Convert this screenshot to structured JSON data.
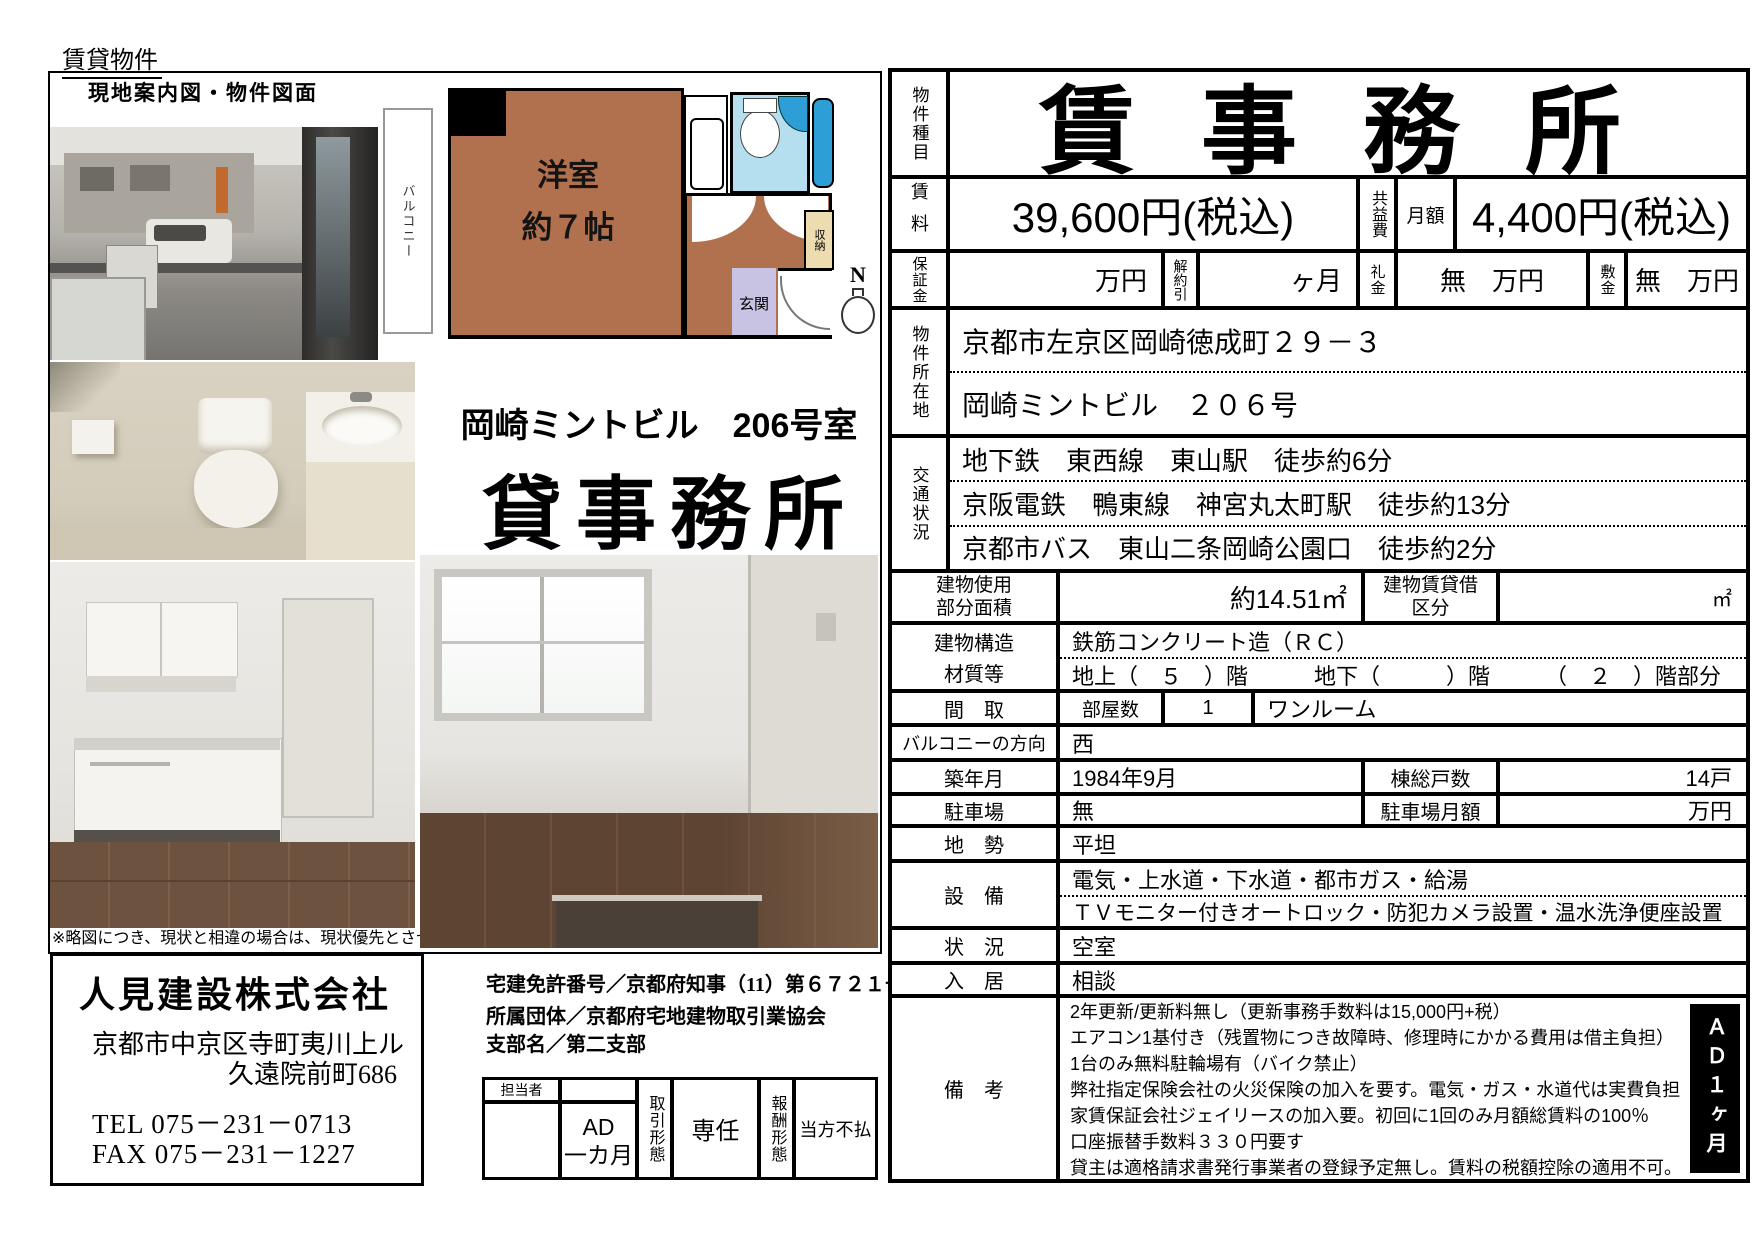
{
  "page": {
    "top_label": "賃貸物件",
    "box_title": "現地案内図・物件図面",
    "note": "※略図につき、現状と相違の場合は、現状優先とさせて頂きま"
  },
  "floor_plan": {
    "balcony": "バルコニー",
    "room_line1": "洋室",
    "room_line2": "約７帖",
    "closet": "収納",
    "entrance": "玄関",
    "north": "N"
  },
  "property": {
    "building_room": "岡崎ミントビル　206号室",
    "type_big": "貸事務所"
  },
  "agency": {
    "name": "人見建設株式会社",
    "address1": "京都市中京区寺町夷川上ル",
    "address2": "久遠院前町686",
    "tel": "TEL  075－231－0713",
    "fax": "FAX  075－231－1227",
    "license": "宅建免許番号／京都府知事（11）第６７２１号",
    "org": "所属団体／京都府宅地建物取引業協会",
    "branch": "支部名／第二支部"
  },
  "staff_table": {
    "manager_label": "担当者",
    "ad_line1": "AD",
    "ad_line2": "一カ月",
    "deal_type_label": "取引形態",
    "deal_type_value": "専任",
    "reward_label": "報酬形態",
    "reward_value": "当方不払"
  },
  "table": {
    "type_label": "物件種目",
    "type_value": "賃事務所",
    "rent_label": "賃料",
    "rent_value": "39,600円(税込)",
    "kyoueki_label": "共益費",
    "monthly_label": "月額",
    "kyoueki_value": "4,400円(税込)",
    "deposit_label": "保証金",
    "deposit_value": "万円",
    "kaiyaku_label": "解約引",
    "kaiyaku_value": "ヶ月",
    "reikin_label": "礼金",
    "reikin_value": "無　万円",
    "shikikin_label": "敷金",
    "shikikin_value": "無　万円",
    "location_label": "物件所在地",
    "location_lines": [
      "京都市左京区岡崎徳成町２９－３",
      "岡崎ミントビル　２０６号"
    ],
    "transit_label": "交通状況",
    "transit_lines": [
      "地下鉄　東西線　東山駅　徒歩約6分",
      "京阪電鉄　鴨東線　神宮丸太町駅　徒歩約13分",
      "京都市バス　東山二条岡崎公園口　徒歩約2分"
    ],
    "area_label_1": "建物使用",
    "area_label_2": "部分面積",
    "area_value": "約14.51㎡",
    "kubun_label_1": "建物賃貸借",
    "kubun_label_2": "区分",
    "kubun_value": "㎡",
    "structure_label_1": "建物構造",
    "structure_label_2": "材質等",
    "structure_line1": "鉄筋コンクリート造（ＲＣ）",
    "structure_line2": "地上（　５　）階　　　地下（　　　）階　　　（　２　）階部分",
    "madori_label": "間　取",
    "rooms_label": "部屋数",
    "rooms_value": "1",
    "madori_value": "ワンルーム",
    "balcony_label": "バルコニーの方向",
    "balcony_value": "西",
    "built_label": "築年月",
    "built_value": "1984年9月",
    "units_label": "棟総戸数",
    "units_value": "14戸",
    "parking_label": "駐車場",
    "parking_value": "無",
    "parking_fee_label": "駐車場月額",
    "parking_fee_value": "万円",
    "land_label": "地　勢",
    "land_value": "平坦",
    "equip_label": "設　備",
    "equip_line1": "電気・上水道・下水道・都市ガス・給湯",
    "equip_line2": "ＴＶモニター付きオートロック・防犯カメラ設置・温水洗浄便座設置",
    "status_label": "状　況",
    "status_value": "空室",
    "nyukyo_label": "入　居",
    "nyukyo_value": "相談",
    "remarks_label": "備　考",
    "remarks_lines": [
      "2年更新/更新料無し（更新事務手数料は15,000円+税）",
      "エアコン1基付き（残置物につき故障時、修理時にかかる費用は借主負担）",
      "1台のみ無料駐輪場有（バイク禁止）",
      "弊社指定保険会社の火災保険の加入を要す。電気・ガス・水道代は実費負担",
      "家賃保証会社ジェイリースの加入要。初回に1回のみ月額総賃料の100％",
      "口座振替手数料３３０円要す",
      "貸主は適格請求書発行事業者の登録予定無し。賃料の税額控除の適用不可。"
    ],
    "ad_box": "ＡＤ１ヶ月"
  },
  "colors": {
    "room_brown": "#b2714e",
    "bath_blue": "#b5dfee",
    "fixture_blue": "#2d9fd6",
    "entrance_purple": "#c9c3e3",
    "closet_beige": "#ecdcb0"
  }
}
